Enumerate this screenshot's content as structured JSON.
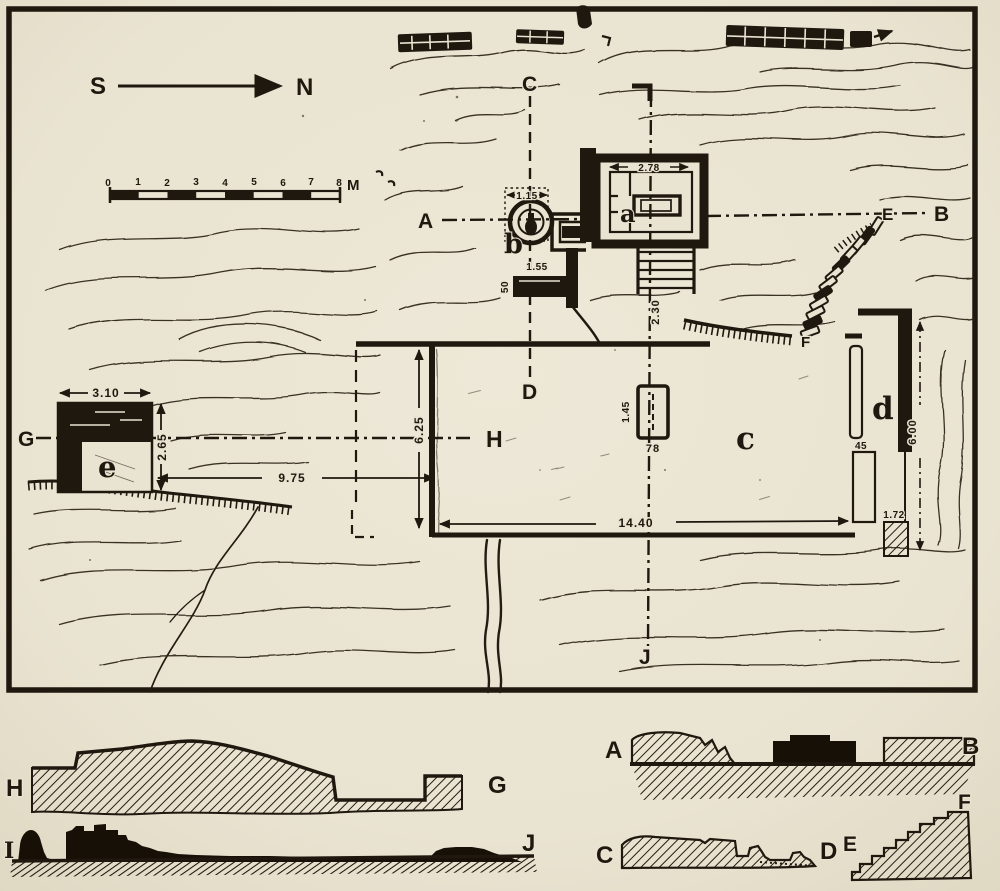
{
  "figure": {
    "kind": "archaeological excavation site plan with section profiles",
    "paper_color": "#e9e3d1",
    "ink_color": "#1f180f"
  },
  "compass": {
    "south": "S",
    "north": "N"
  },
  "scale_bar": {
    "ticks": [
      "0",
      "1",
      "2",
      "3",
      "4",
      "5",
      "6",
      "7",
      "8"
    ],
    "unit": "M"
  },
  "plan_labels": {
    "A": "A",
    "B": "B",
    "C": "C",
    "D": "D",
    "E": "E",
    "F": "F",
    "G": "G",
    "H": "H",
    "J": "J"
  },
  "structures": {
    "a": "a",
    "b": "b",
    "c": "c",
    "d": "d",
    "e": "e"
  },
  "dimensions": {
    "e_width": "3.10",
    "e_height": "2.65",
    "e_to_court": "9.75",
    "court_depth": "6.25",
    "court_length": "14.40",
    "altar_length": "1.45",
    "altar_width": "78",
    "well_diameter": "1.15",
    "slab_length": "1.55",
    "slab_width": "50",
    "cella_width": "2.78",
    "stair_length": "2.30",
    "trench_d_length": "6.00",
    "trench_d_end": "1.72",
    "trench_d_width": "45"
  },
  "sections": {
    "HG": {
      "left": "H",
      "right": "G"
    },
    "IJ": {
      "left": "I",
      "right": "J"
    },
    "AB": {
      "left": "A",
      "right": "B"
    },
    "CD": {
      "left": "C",
      "right": "D"
    },
    "EF": {
      "left": "E",
      "right": "F"
    }
  }
}
